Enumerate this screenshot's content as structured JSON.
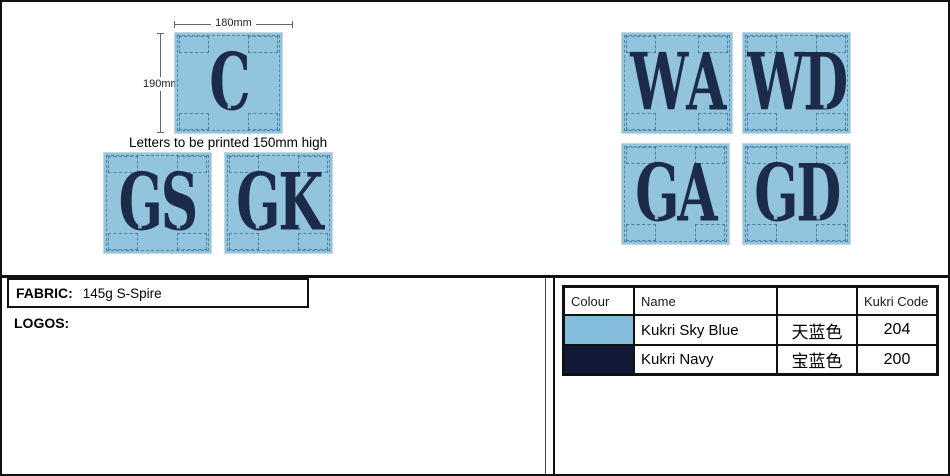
{
  "page": {
    "note": "Letters to be printed 150mm high",
    "dimensions": {
      "width_label": "180mm",
      "height_label": "190mm"
    }
  },
  "bibs": [
    {
      "letters": "C"
    },
    {
      "letters": "GS"
    },
    {
      "letters": "GK"
    },
    {
      "letters": "WA"
    },
    {
      "letters": "WD"
    },
    {
      "letters": "GA"
    },
    {
      "letters": "GD"
    }
  ],
  "info": {
    "fabric_label": "FABRIC:",
    "fabric_value": "145g S-Spire",
    "logos_label": "LOGOS:"
  },
  "colors": {
    "bib_fill": "#92c4de",
    "letter_navy": "#1d2b4a",
    "sky_blue": "#85bedd",
    "navy": "#111b38"
  },
  "color_table": {
    "headers": [
      "Colour",
      "Name",
      "",
      "Kukri Code"
    ],
    "rows": [
      {
        "swatch": "#85bedd",
        "name": "Kukri Sky Blue",
        "chinese": "天蓝色",
        "code": "204"
      },
      {
        "swatch": "#111b38",
        "name": "Kukri Navy",
        "chinese": "宝蓝色",
        "code": "200"
      }
    ]
  }
}
